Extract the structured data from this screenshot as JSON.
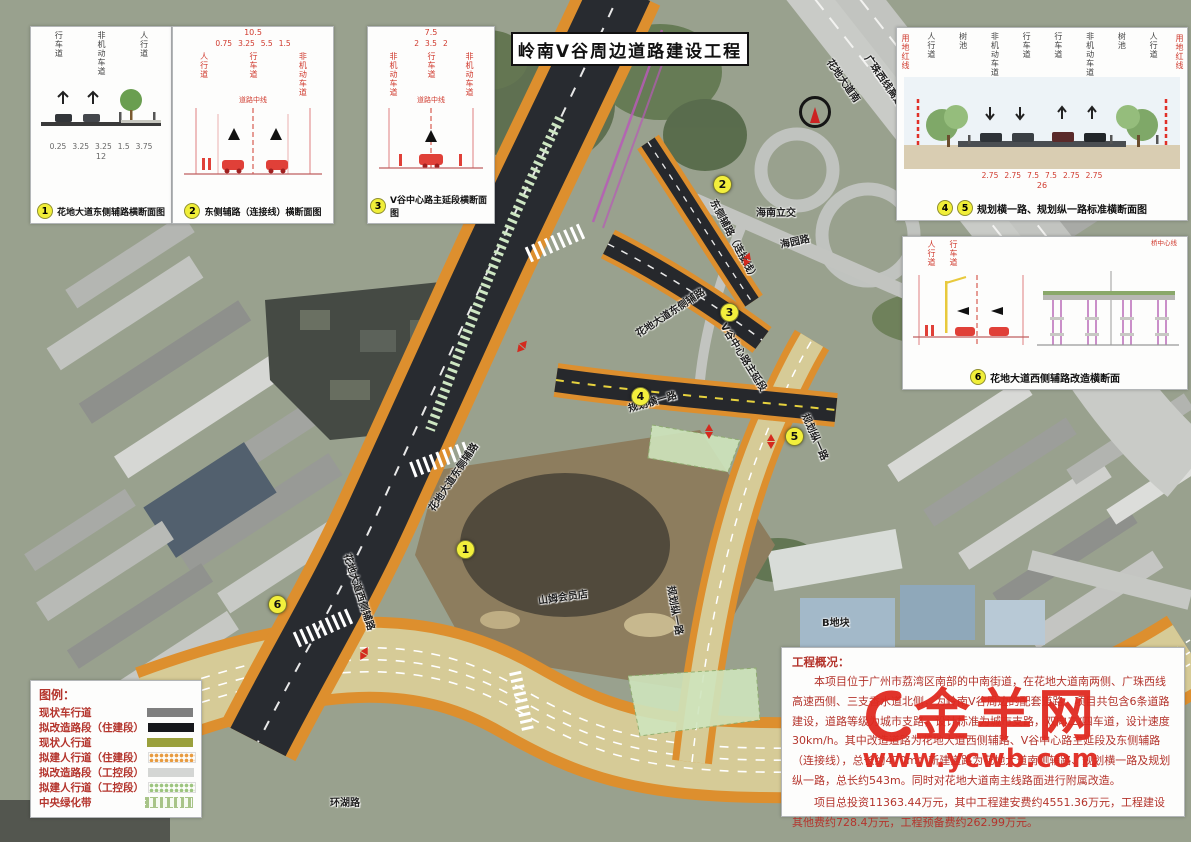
{
  "title": "岭南V谷周边道路建设工程",
  "watermark": {
    "name": "金羊网",
    "url": "www.ycwb.com"
  },
  "legend": {
    "title": "图例：",
    "items": [
      {
        "label": "现状车行道",
        "color": "#7f7f7f",
        "pattern": "solid"
      },
      {
        "label": "拟改造路段（住建段）",
        "color": "#17181c",
        "pattern": "solid"
      },
      {
        "label": "现状人行道",
        "color": "#9aa03c",
        "pattern": "solid"
      },
      {
        "label": "拟建人行道（住建段）",
        "color": "#e89b3f",
        "pattern": "dots"
      },
      {
        "label": "拟改造路段（工控段）",
        "color": "#d4d6d4",
        "pattern": "solid"
      },
      {
        "label": "拟建人行道（工控段）",
        "color": "#9cc47e",
        "pattern": "dots"
      },
      {
        "label": "中央绿化带",
        "color": "#a8c488",
        "pattern": "dashes"
      }
    ]
  },
  "overview": {
    "title": "工程概况：",
    "paragraphs": [
      "本项目位于广州市荔湾区南部的中南街道，在花地大道南两侧、广珠西线高速西侧、三支香水道北侧，为岭南V谷周边的配套道路。项目共包含6条道路建设，道路等级为城市支路，设计标准为城市支路，双向二/四车道，设计速度30km/h。其中改造道路为花地大道西侧辅路、V谷中心路主延段及东侧辅路（连接线），总长约470m；新建道路为花地大道南侧辅路、规划横一路及规划纵一路，总长约543m。同时对花地大道南主线路面进行附属改造。",
      "项目总投资11363.44万元，其中工程建安费约4551.36万元，工程建设其他费约728.4万元，工程预备费约262.99万元。"
    ]
  },
  "diagrams": {
    "d1": {
      "num": "1",
      "caption": "花地大道东侧辅路横断面图",
      "top_labels": [
        "行车道",
        "非机动车道",
        "人行道"
      ],
      "dims": [
        "0.25",
        "3.25",
        "3.25",
        "1.5",
        "3.75"
      ],
      "total": "12"
    },
    "d2": {
      "num": "2",
      "caption": "东侧辅路（连接线）横断面图",
      "mid_label": "道路中线",
      "top_labels": [
        "人行道",
        "行车道",
        "非机动车道"
      ],
      "dims": [
        "0.75",
        "3.25",
        "5.5",
        "1.5"
      ],
      "total": "10.5"
    },
    "d3": {
      "num": "3",
      "caption": "V谷中心路主延段横断面图",
      "mid_label": "道路中线",
      "top_labels": [
        "非机动车道",
        "行车道",
        "非机动车道"
      ],
      "dims": [
        "2",
        "3.5",
        "2"
      ],
      "total": "7.5"
    },
    "d45": {
      "num1": "4",
      "num2": "5",
      "caption": "规划横一路、规划纵一路标准横断面图",
      "edge_label": "用地红线",
      "top_labels": [
        "人行道",
        "树池",
        "非机动车道",
        "行车道",
        "行车道",
        "非机动车道",
        "树池",
        "人行道"
      ],
      "dims": [
        "2.75",
        "2.75",
        "7.5",
        "7.5",
        "2.75",
        "2.75"
      ],
      "total": "26"
    },
    "d6": {
      "num": "6",
      "caption": "花地大道西侧辅路改造横断面",
      "bridge_label": "桥中心线",
      "top_labels": [
        "人行道",
        "行车道"
      ]
    }
  },
  "map": {
    "labels": [
      {
        "text": "花地大道南",
        "x": 830,
        "y": 52,
        "rot": 55
      },
      {
        "text": "广珠西线高速",
        "x": 868,
        "y": 48,
        "rot": 55
      },
      {
        "text": "海南立交",
        "x": 756,
        "y": 204,
        "rot": 0
      },
      {
        "text": "海园路",
        "x": 780,
        "y": 236,
        "rot": -12
      },
      {
        "text": "东侧辅路（连接线）",
        "x": 714,
        "y": 192,
        "rot": 62
      },
      {
        "text": "V谷中心路主延段",
        "x": 724,
        "y": 316,
        "rot": 58
      },
      {
        "text": "花地大道东侧辅路",
        "x": 636,
        "y": 326,
        "rot": -33
      },
      {
        "text": "规划横一路",
        "x": 628,
        "y": 400,
        "rot": -16
      },
      {
        "text": "规划纵一路",
        "x": 806,
        "y": 406,
        "rot": 66
      },
      {
        "text": "花地大道东侧辅路",
        "x": 430,
        "y": 502,
        "rot": -56
      },
      {
        "text": "花地大道西侧辅路",
        "x": 348,
        "y": 546,
        "rot": 72
      },
      {
        "text": "山姆会员店",
        "x": 538,
        "y": 592,
        "rot": -8
      },
      {
        "text": "规划纵一路",
        "x": 672,
        "y": 578,
        "rot": 80
      },
      {
        "text": "B地块",
        "x": 822,
        "y": 614,
        "rot": 0
      },
      {
        "text": "环湖路",
        "x": 330,
        "y": 794,
        "rot": 0
      }
    ],
    "markers": [
      {
        "num": "1",
        "x": 465,
        "y": 549
      },
      {
        "num": "2",
        "x": 722,
        "y": 184
      },
      {
        "num": "3",
        "x": 729,
        "y": 312
      },
      {
        "num": "4",
        "x": 640,
        "y": 396
      },
      {
        "num": "5",
        "x": 794,
        "y": 436
      },
      {
        "num": "6",
        "x": 277,
        "y": 604
      }
    ],
    "arrows": [
      {
        "x": 748,
        "y": 258,
        "rot": 20
      },
      {
        "x": 710,
        "y": 430,
        "rot": 0
      },
      {
        "x": 772,
        "y": 440,
        "rot": 0
      },
      {
        "x": 523,
        "y": 345,
        "rot": 40
      },
      {
        "x": 365,
        "y": 652,
        "rot": 30
      }
    ]
  }
}
